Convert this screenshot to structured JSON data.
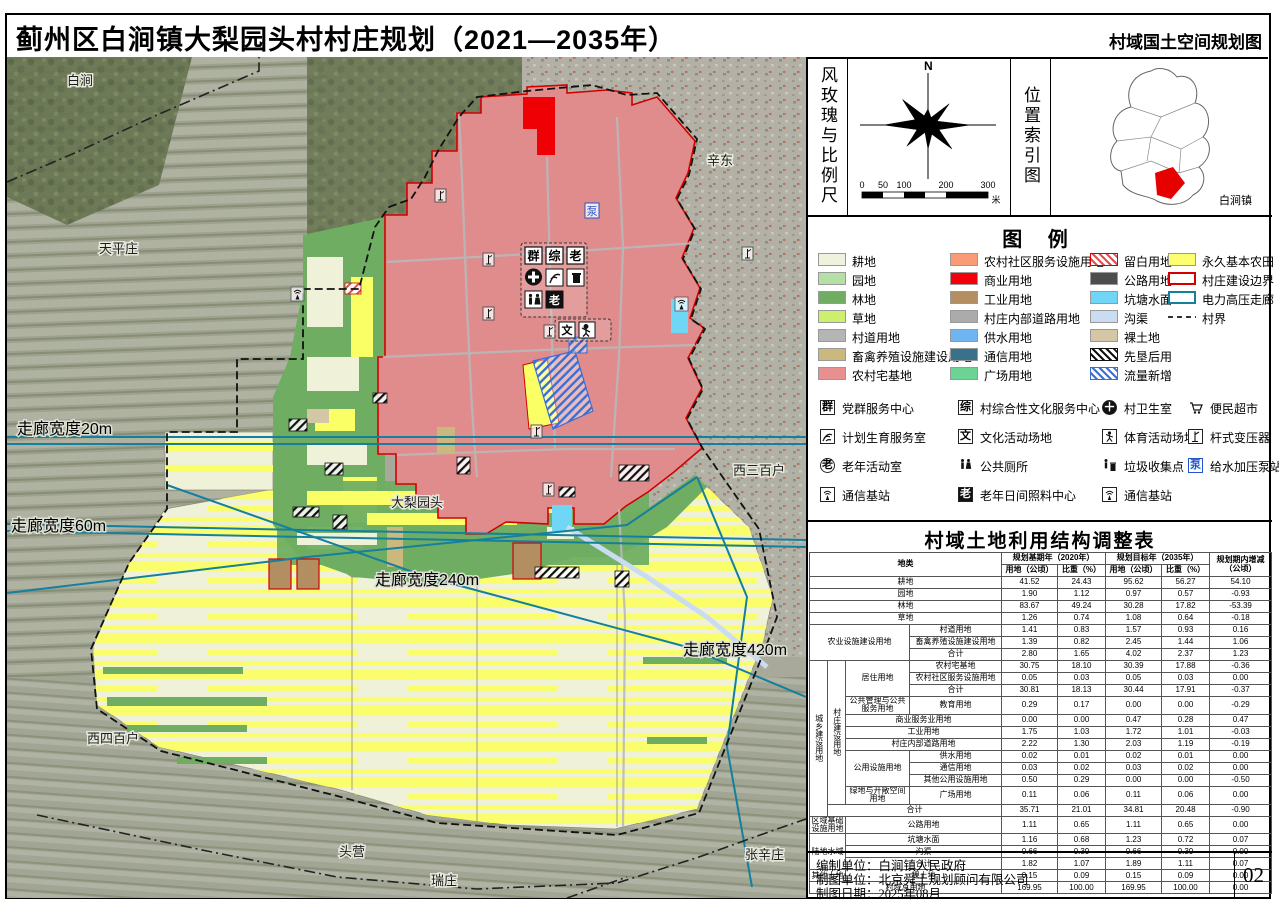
{
  "title": {
    "main": "蓟州区白涧镇大梨园头村村庄规划（2021—2035年）",
    "sub": "村域国土空间规划图"
  },
  "compass": {
    "panel_label": "风玫瑰与比例尺",
    "north": "N",
    "scale_ticks": [
      "0",
      "50",
      "100",
      "200",
      "300"
    ],
    "scale_unit": "米"
  },
  "location": {
    "panel_label": "位置索引图",
    "town_label": "白涧镇"
  },
  "legend": {
    "title": "图  例",
    "items": [
      {
        "name": "cropland",
        "label": "耕地",
        "swatch": "fill",
        "color": "#EFF2DC"
      },
      {
        "name": "orchard",
        "label": "园地",
        "swatch": "fill",
        "color": "#B5DFA5"
      },
      {
        "name": "forest",
        "label": "林地",
        "swatch": "fill",
        "color": "#6FAE62"
      },
      {
        "name": "grassland",
        "label": "草地",
        "swatch": "fill",
        "color": "#CCEF6E"
      },
      {
        "name": "village-road",
        "label": "村道用地",
        "swatch": "fill",
        "color": "#B5B5B5"
      },
      {
        "name": "livestock-facility",
        "label": "畜禽养殖设施建设用地",
        "swatch": "fill",
        "color": "#CBB87D"
      },
      {
        "name": "rural-homestead",
        "label": "农村宅基地",
        "swatch": "fill",
        "color": "#E89090"
      },
      {
        "name": "community-service",
        "label": "农村社区服务设施用地",
        "swatch": "fill",
        "color": "#F89B76"
      },
      {
        "name": "commercial",
        "label": "商业用地",
        "swatch": "fill",
        "color": "#F3000A"
      },
      {
        "name": "industrial",
        "label": "工业用地",
        "swatch": "fill",
        "color": "#B28E60"
      },
      {
        "name": "village-internal-road",
        "label": "村庄内部道路用地",
        "swatch": "fill",
        "color": "#ABABAB"
      },
      {
        "name": "water-supply",
        "label": "供水用地",
        "swatch": "fill",
        "color": "#6EB5F2"
      },
      {
        "name": "telecom-land",
        "label": "通信用地",
        "swatch": "fill",
        "color": "#39708A"
      },
      {
        "name": "plaza",
        "label": "广场用地",
        "swatch": "fill",
        "color": "#6BD393"
      },
      {
        "name": "reserved-white",
        "label": "留白用地",
        "swatch": "hatch-red",
        "color": "#E05050"
      },
      {
        "name": "highway",
        "label": "公路用地",
        "swatch": "fill",
        "color": "#4D4D4D"
      },
      {
        "name": "pond",
        "label": "坑塘水面",
        "swatch": "fill",
        "color": "#70D6F5"
      },
      {
        "name": "ditch",
        "label": "沟渠",
        "swatch": "fill",
        "color": "#C9DCF2"
      },
      {
        "name": "bare-land",
        "label": "裸土地",
        "swatch": "fill",
        "color": "#D3C7A6"
      },
      {
        "name": "reclaim-first",
        "label": "先垦后用",
        "swatch": "hatch-black",
        "color": "#111111"
      },
      {
        "name": "flow-increase",
        "label": "流量新增",
        "swatch": "hatch-blue",
        "color": "#3B6FD4"
      },
      {
        "name": "permanent-farmland",
        "label": "永久基本农田",
        "swatch": "fill",
        "color": "#FDFF6E"
      },
      {
        "name": "village-construction-boundary",
        "label": "村庄建设边界",
        "swatch": "outline",
        "color": "#D40000"
      },
      {
        "name": "power-corridor",
        "label": "电力高压走廊",
        "swatch": "outline",
        "color": "#157F9E"
      },
      {
        "name": "village-border",
        "label": "村界",
        "swatch": "dash",
        "color": "#333333"
      }
    ],
    "icons": [
      {
        "glyph": "群",
        "label": "党群服务中心"
      },
      {
        "glyph": "综",
        "label": "村综合性文化服务中心"
      },
      {
        "glyph": "＋",
        "label": "村卫生室"
      },
      {
        "glyph": "",
        "label": "便民超市"
      },
      {
        "glyph": "",
        "label": "计划生育服务室"
      },
      {
        "glyph": "文",
        "label": "文化活动场地"
      },
      {
        "glyph": "",
        "label": "体育活动场地"
      },
      {
        "glyph": "",
        "label": "杆式变压器"
      },
      {
        "glyph": "老",
        "label": "老年活动室"
      },
      {
        "glyph": "",
        "label": "公共厕所"
      },
      {
        "glyph": "",
        "label": "垃圾收集点"
      },
      {
        "glyph": "泵",
        "label": "给水加压泵站"
      },
      {
        "glyph": "",
        "label": "通信基站"
      },
      {
        "glyph": "老",
        "label": "老年日间照料中心"
      },
      {
        "glyph": "",
        "label": "通信基站"
      }
    ]
  },
  "map": {
    "labels": [
      {
        "text": "白涧"
      },
      {
        "text": "辛东"
      },
      {
        "text": "天平庄"
      },
      {
        "text": "西三百户"
      },
      {
        "text": "大梨园头"
      },
      {
        "text": "西四百户"
      },
      {
        "text": "头营"
      },
      {
        "text": "瑞庄"
      },
      {
        "text": "张辛庄"
      },
      {
        "text": "走廊宽度20m"
      },
      {
        "text": "走廊宽度60m"
      },
      {
        "text": "走廊宽度240m"
      },
      {
        "text": "走廊宽度420m"
      }
    ]
  },
  "table": {
    "title": "村域土地利用结构调整表",
    "headers": {
      "category": "地类",
      "base_year": "规划基期年（2020年）",
      "target_year": "规划目标年（2035年）",
      "area": "用地（公顷）",
      "ratio": "比重（%）",
      "change": "规划期内增减（公顷）"
    },
    "rows": [
      {
        "cat": [
          "耕地"
        ],
        "v": [
          "41.52",
          "24.43",
          "95.62",
          "56.27",
          "54.10"
        ]
      },
      {
        "cat": [
          "园地"
        ],
        "v": [
          "1.90",
          "1.12",
          "0.97",
          "0.57",
          "-0.93"
        ]
      },
      {
        "cat": [
          "林地"
        ],
        "v": [
          "83.67",
          "49.24",
          "30.28",
          "17.82",
          "-53.39"
        ]
      },
      {
        "cat": [
          "草地"
        ],
        "v": [
          "1.26",
          "0.74",
          "1.08",
          "0.64",
          "-0.18"
        ]
      },
      {
        "cat": [
          "农业设施建设用地",
          "村道用地"
        ],
        "v": [
          "1.41",
          "0.83",
          "1.57",
          "0.93",
          "0.16"
        ]
      },
      {
        "cat": [
          "畜禽养殖设施建设用地"
        ],
        "v": [
          "1.39",
          "0.82",
          "2.45",
          "1.44",
          "1.06"
        ]
      },
      {
        "cat": [
          "合计"
        ],
        "v": [
          "2.80",
          "1.65",
          "4.02",
          "2.37",
          "1.23"
        ]
      },
      {
        "cat": [
          "城乡建设用地",
          "村庄建设用地",
          "居住用地",
          "农村宅基地"
        ],
        "v": [
          "30.75",
          "18.10",
          "30.39",
          "17.88",
          "-0.36"
        ]
      },
      {
        "cat": [
          "农村社区服务设施用地"
        ],
        "v": [
          "0.05",
          "0.03",
          "0.05",
          "0.03",
          "0.00"
        ]
      },
      {
        "cat": [
          "合计"
        ],
        "v": [
          "30.81",
          "18.13",
          "30.44",
          "17.91",
          "-0.37"
        ]
      },
      {
        "cat": [
          "公共管理与公共服务用地",
          "教育用地"
        ],
        "v": [
          "0.29",
          "0.17",
          "0.00",
          "0.00",
          "-0.29"
        ]
      },
      {
        "cat": [
          "商业服务业用地"
        ],
        "v": [
          "0.00",
          "0.00",
          "0.47",
          "0.28",
          "0.47"
        ]
      },
      {
        "cat": [
          "工业用地"
        ],
        "v": [
          "1.75",
          "1.03",
          "1.72",
          "1.01",
          "-0.03"
        ]
      },
      {
        "cat": [
          "村庄内部道路用地"
        ],
        "v": [
          "2.22",
          "1.30",
          "2.03",
          "1.19",
          "-0.19"
        ]
      },
      {
        "cat": [
          "公用设施用地",
          "供水用地"
        ],
        "v": [
          "0.02",
          "0.01",
          "0.02",
          "0.01",
          "0.00"
        ]
      },
      {
        "cat": [
          "通信用地"
        ],
        "v": [
          "0.03",
          "0.02",
          "0.03",
          "0.02",
          "0.00"
        ]
      },
      {
        "cat": [
          "其他公用设施用地"
        ],
        "v": [
          "0.50",
          "0.29",
          "0.00",
          "0.00",
          "-0.50"
        ]
      },
      {
        "cat": [
          "绿地与开敞空间用地",
          "广场用地"
        ],
        "v": [
          "0.11",
          "0.06",
          "0.11",
          "0.06",
          "0.00"
        ]
      },
      {
        "cat": [
          "合计"
        ],
        "v": [
          "35.71",
          "21.01",
          "34.81",
          "20.48",
          "-0.90"
        ]
      },
      {
        "cat": [
          "区域基础设施用地",
          "公路用地"
        ],
        "v": [
          "1.11",
          "0.65",
          "1.11",
          "0.65",
          "0.00"
        ]
      },
      {
        "cat": [
          "陆地水域",
          "坑塘水面"
        ],
        "v": [
          "1.16",
          "0.68",
          "1.23",
          "0.72",
          "0.07"
        ]
      },
      {
        "cat": [
          "沟渠"
        ],
        "v": [
          "0.66",
          "0.39",
          "0.66",
          "0.39",
          "0.00"
        ]
      },
      {
        "cat": [
          "合计"
        ],
        "v": [
          "1.82",
          "1.07",
          "1.89",
          "1.11",
          "0.07"
        ]
      },
      {
        "cat": [
          "其他土地",
          "裸土地"
        ],
        "v": [
          "0.15",
          "0.09",
          "0.15",
          "0.09",
          "0.00"
        ]
      },
      {
        "cat": [
          "村域总用地"
        ],
        "v": [
          "169.95",
          "100.00",
          "169.95",
          "100.00",
          "0.00"
        ]
      }
    ]
  },
  "credits": {
    "line1": "编制单位：白涧镇人民政府",
    "line2": "制图单位：北京舜土规划顾问有限公司",
    "line3": "制图日期：2025年08月",
    "page": "02"
  },
  "colors": {
    "built_area": "#E08C8C",
    "construction_boundary": "#D40000",
    "power_corridor": "#157F9E",
    "permanent_farmland": "#FBFF66",
    "cropland": "#F0F1D9",
    "forest": "#6FAE62"
  }
}
